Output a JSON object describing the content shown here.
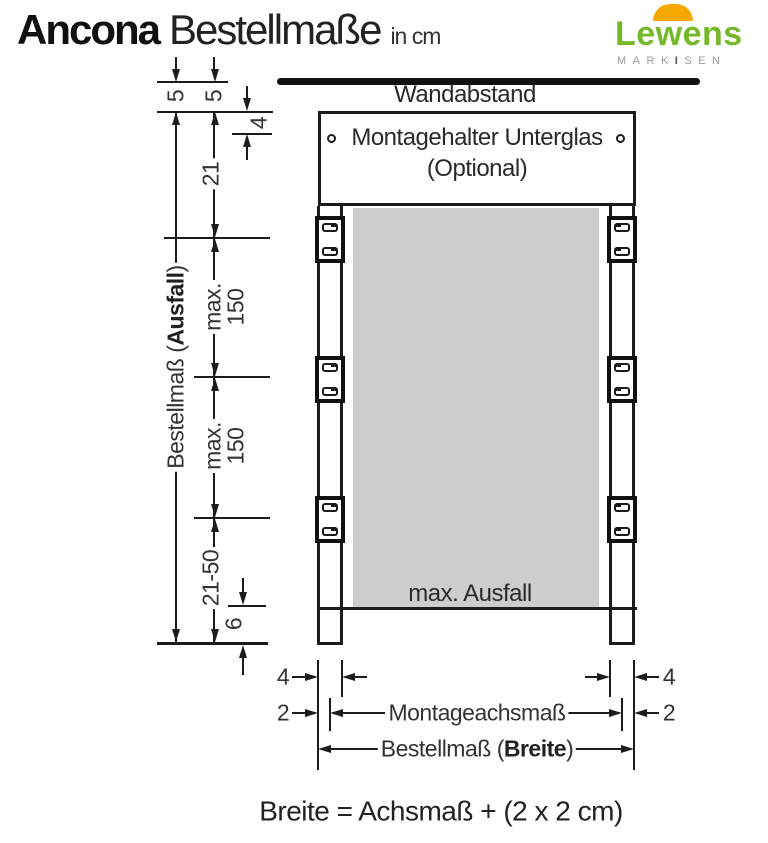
{
  "header": {
    "title": {
      "brand": "Ancona",
      "main": "Bestellmaße",
      "unit": "in cm"
    },
    "logo": {
      "brand": "Lewens",
      "tagline_left": "MARK",
      "tagline_mid": "I",
      "tagline_right": "SEN"
    }
  },
  "colors": {
    "logo_green": "#76b82a",
    "logo_orange": "#f5a800",
    "line_black": "#1c1c1c",
    "fabric_gray": "#cdcdcd"
  },
  "diagram": {
    "labels": {
      "wall": "Wandabstand",
      "mount_line1": "Montagehalter Unterglas",
      "mount_line2": "(Optional)",
      "fabric": "max. Ausfall",
      "axis": "Montageachsmaß",
      "order_drop_prefix": "Bestellmaß (",
      "order_drop_bold": "Ausfall",
      "order_drop_suffix": ")",
      "order_width_prefix": "Bestellmaß (",
      "order_width_bold": "Breite",
      "order_width_suffix": ")"
    },
    "dims": {
      "top_gap_1": "5",
      "top_gap_2": "5",
      "holder_height": "4",
      "head_section": "21",
      "max_drop_upper_word": "max.",
      "max_drop_upper_value": "150",
      "max_drop_lower_word": "max.",
      "max_drop_lower_value": "150",
      "foot_section": "21-50",
      "foot_offset": "6",
      "rail_width_left": "4",
      "rail_width_right": "4",
      "axis_offset_left": "2",
      "axis_offset_right": "2"
    },
    "formula": "Breite = Achsmaß + (2 x 2 cm)"
  }
}
